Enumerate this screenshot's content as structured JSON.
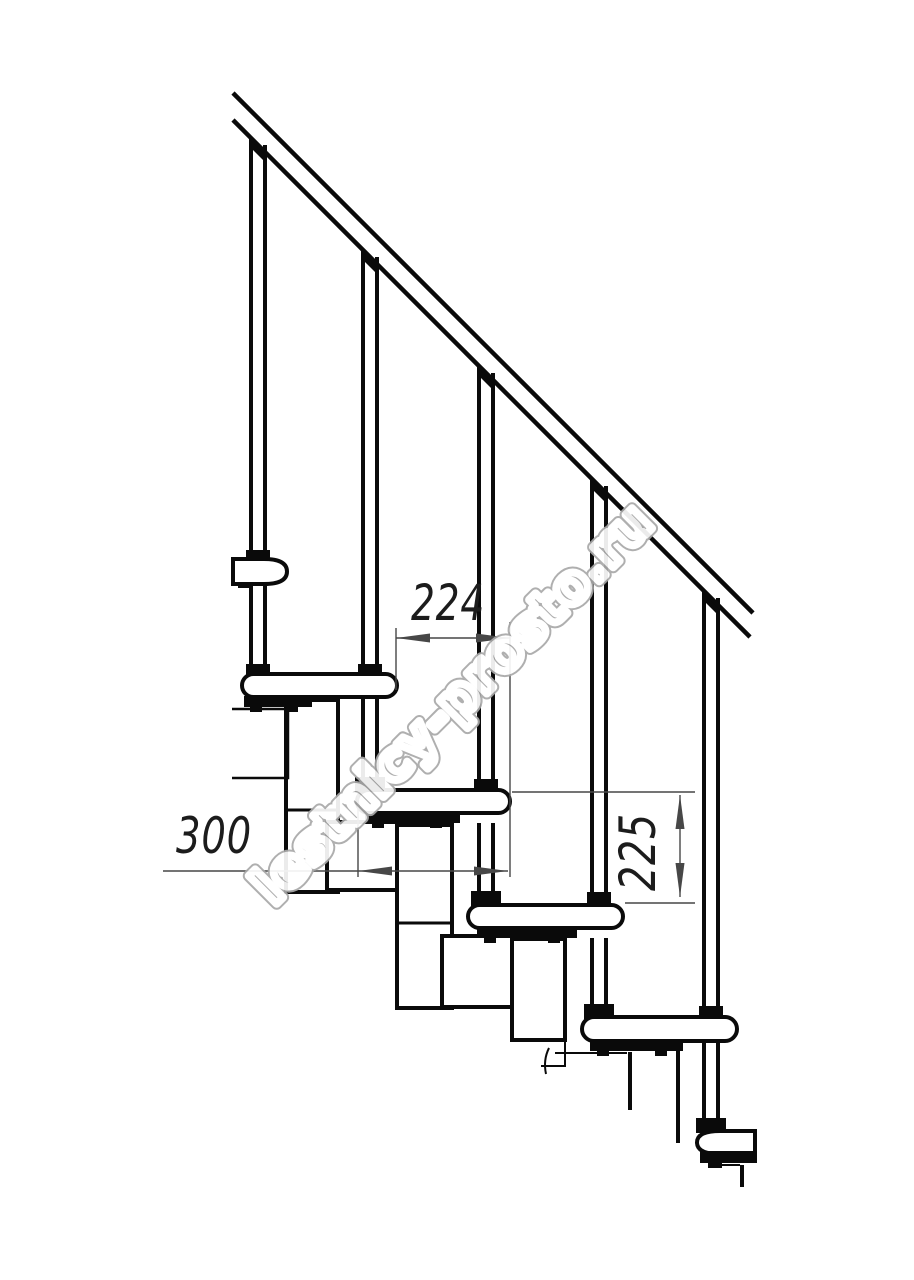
{
  "drawing": {
    "dimensions": {
      "step_offset": "224",
      "tread_length": "300",
      "riser_height": "225"
    },
    "watermark": "lestnicy-prosto.ru",
    "colors": {
      "line": "#0a0a0a",
      "dimension": "#444444",
      "watermark_outline": "#a9a9a9",
      "background": "#ffffff"
    }
  }
}
